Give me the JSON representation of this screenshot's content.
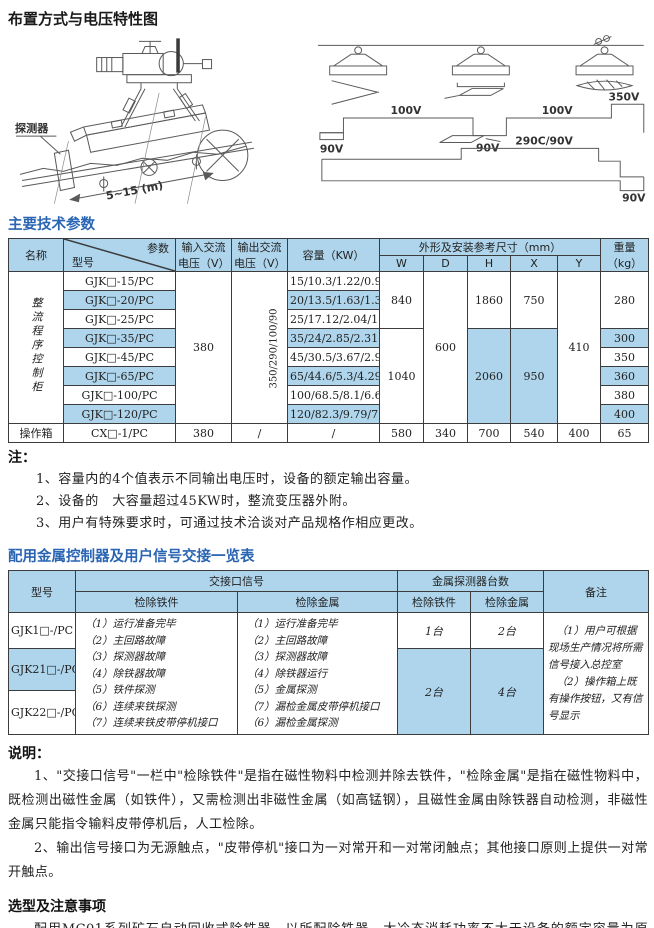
{
  "headings": {
    "layout": "布置方式与电压特性图",
    "params": "主要技术参数",
    "notes": "注：",
    "signal_table": "配用金属控制器及用户信号交接一览表",
    "explain": "说明：",
    "selection": "选型及注意事项"
  },
  "diagrams": {
    "left": {
      "detector": "探测器",
      "distance": "5~15 (m)"
    },
    "right": {
      "v90_left": "90V",
      "v100_left": "100V",
      "v90_mid": "90V",
      "v100_right": "100V",
      "v350": "350V",
      "v290": "290C/90V",
      "v90_bottom": "90V"
    }
  },
  "t1": {
    "headers": {
      "name": "名称",
      "param": "参数",
      "model": "型号",
      "vin": "输入交流电压（V）",
      "vout": "输出交流电压（V）",
      "cap": "容量（KW）",
      "dims": "外形及安装参考尺寸（mm）",
      "w": "W",
      "d": "D",
      "h": "H",
      "x": "X",
      "y": "Y",
      "weight": "重量（kg）"
    },
    "group": "整流程序控制柜",
    "models": [
      "GJK□-15/PC",
      "GJK□-20/PC",
      "GJK□-25/PC",
      "GJK□-35/PC",
      "GJK□-45/PC",
      "GJK□-65/PC",
      "GJK□-100/PC",
      "GJK□-120/PC"
    ],
    "caps": [
      "15/10.3/1.22/0.9",
      "20/13.5/1.63/1.32",
      "25/17.12/2.04/1.65",
      "35/24/2.85/2.31",
      "45/30.5/3.67/2.97",
      "65/44.6/5.3/4.29",
      "100/68.5/8.1/6.61",
      "120/82.3/9.79/7.93"
    ],
    "vin": "380",
    "vout": "350/290/100/90",
    "w1": "840",
    "w2": "1040",
    "d": "600",
    "h1": "1860",
    "h2": "2060",
    "x1": "750",
    "x2": "950",
    "y": "410",
    "wt1": "280",
    "wt4": "300",
    "wt5": "350",
    "wt6": "360",
    "wt7": "380",
    "wt8": "400",
    "op": {
      "name": "操作箱",
      "model": "CX□-1/PC",
      "vin": "380",
      "vout": "/",
      "cap": "/",
      "w": "580",
      "d": "340",
      "h": "700",
      "x": "540",
      "y": "400",
      "wt": "65"
    }
  },
  "notes": {
    "items": [
      "1、容量内的4个值表示不同输出电压时，设备的额定输出容量。",
      "2、设备的　大容量超过45KW时，整流变压器外附。",
      "3、用户有特殊要求时，可通过技术洽谈对产品规格作相应更改。"
    ]
  },
  "t2": {
    "headers": {
      "model": "型号",
      "signal": "交接口信号",
      "iron": "检除铁件",
      "metal": "检除金属",
      "count": "金属探测器台数",
      "count_iron": "检除铁件",
      "count_metal": "检除金属",
      "remark": "备注"
    },
    "models": [
      "GJK1□-/PC",
      "GJK21□-/PC",
      "GJK22□-/PC"
    ],
    "iron_signals": [
      "（1）运行准备完毕",
      "（2）主回路故障",
      "（3）探测器故障",
      "（4）除铁器故障",
      "（5）铁件探测",
      "（6）连续来铁探测",
      "（7）连续来铁皮带停机接口"
    ],
    "metal_signals": [
      "（1）运行准备完毕",
      "（2）主回路故障",
      "（3）探测器故障",
      "（4）除铁器运行",
      "（5）金属探测",
      "（7）漏检金属皮带停机接口",
      "（6）漏检金属探测"
    ],
    "counts": {
      "r1_iron": "1台",
      "r1_metal": "2台",
      "r23_iron": "2台",
      "r23_metal": "4台"
    },
    "remarks": [
      "（1）用户可根据现场生产情况将所需信号接入总控室",
      "（2）操作箱上既有操作按钮，又有信号显示"
    ]
  },
  "explain": {
    "paras": [
      "1、\"交接口信号\"一栏中\"检除铁件\"是指在磁性物料中检测并除去铁件，\"检除金属\"是指在磁性物料中，既检测出磁性金属（如铁件），又需检测出非磁性金属（如高锰钢），且磁性金属由除铁器自动检测，非磁性金属只能指令输料皮带停机后，人工检除。",
      "2、输出信号接口为无源触点，\"皮带停机\"接口为一对常开和一对常闭触点；其他接口原则上提供一对常开触点。"
    ]
  },
  "selection": {
    "body": "配用MC01系列矿石自动回收式除铁器，以所配除铁器　大冷态消耗功率不大于设备的额定容量为原则。"
  }
}
